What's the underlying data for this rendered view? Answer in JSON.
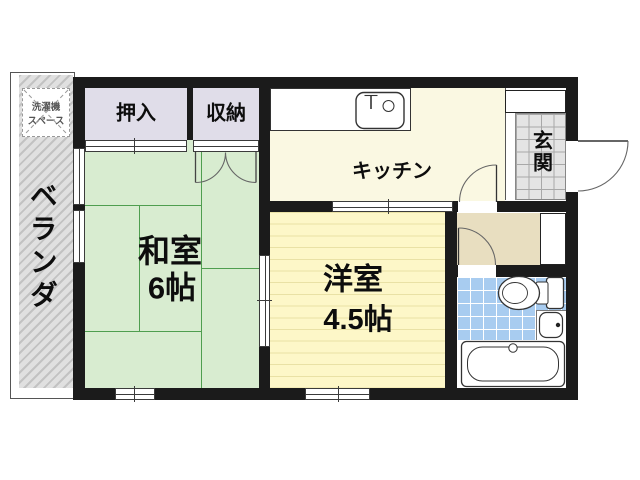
{
  "rooms": {
    "balcony": {
      "label": "ベランダ"
    },
    "washer_space": {
      "line1": "洗濯機",
      "line2": "スペース"
    },
    "oshiire": {
      "label": "押入"
    },
    "storage": {
      "label": "収納"
    },
    "kitchen": {
      "label": "キッチン"
    },
    "genkan": {
      "label": "玄関"
    },
    "washitsu": {
      "label": "和室",
      "size": "6帖"
    },
    "youshitsu": {
      "label": "洋室",
      "size": "4.5帖"
    }
  },
  "fixtures": [
    "kitchen-sink",
    "toilet",
    "washbasin",
    "bathtub",
    "washing-machine-space"
  ],
  "colors": {
    "wall": "#1b1b1b",
    "line": "#3b3b3b",
    "tatami": "#d8ecd0",
    "tatami-line": "#4f9e4f",
    "flooring": "#fdf7c8",
    "flooring-line": "#e9e1a5",
    "kitchen": "#faf8e2",
    "closet": "#e0dde9",
    "washroom": "#e8dec0",
    "tile-blue": "#a8ccf0",
    "genkan-tile": "#e4e4e4",
    "genkan-line": "#a8a8a8",
    "hatch-bg": "#e0e0e0",
    "hatch-line": "#c2c2c2"
  }
}
